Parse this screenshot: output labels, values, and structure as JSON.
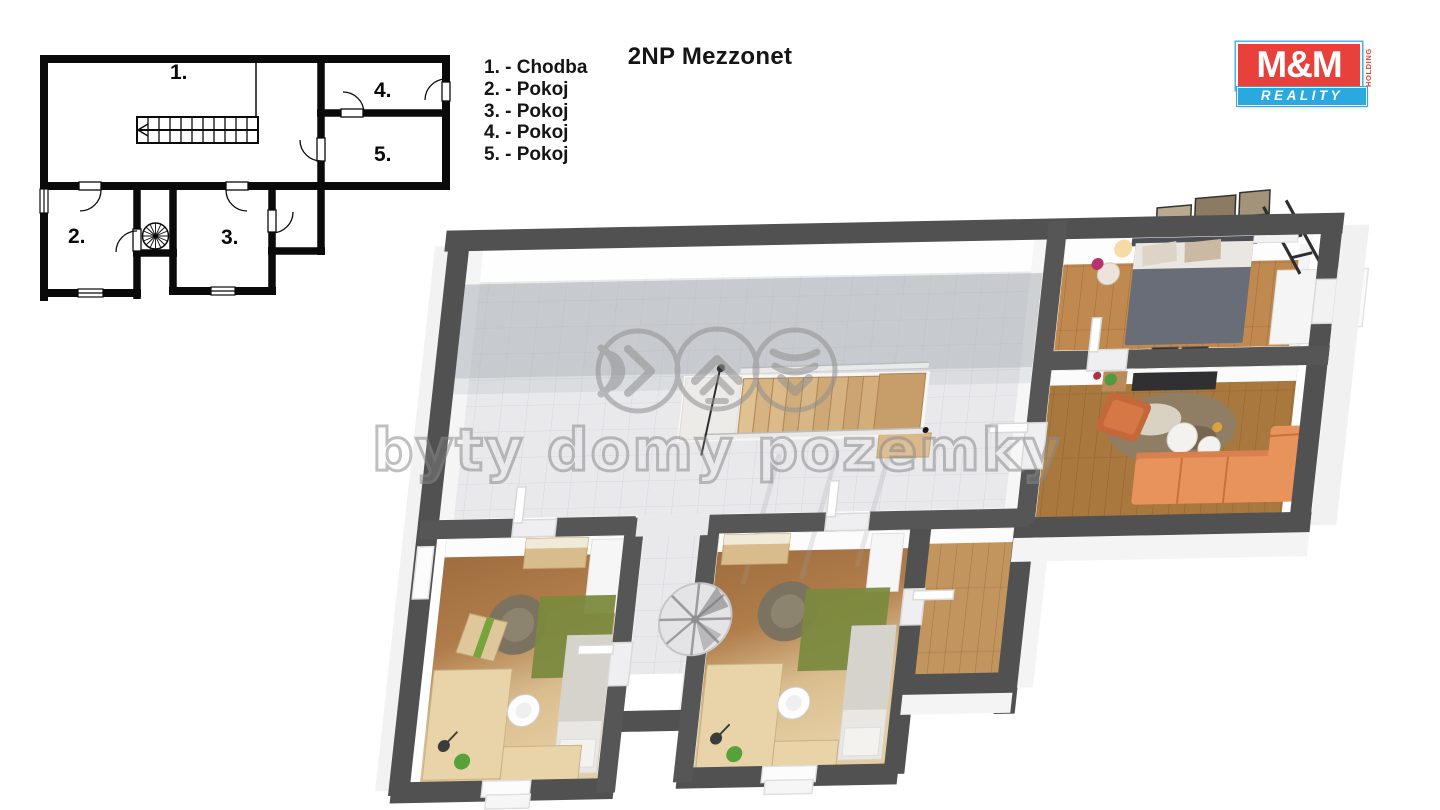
{
  "title": "2NP Mezzonet",
  "legend": {
    "items": [
      "1. - Chodba",
      "2. - Pokoj",
      "3. - Pokoj",
      "4. - Pokoj",
      "5. - Pokoj"
    ]
  },
  "plan2d": {
    "labels": [
      "1.",
      "2.",
      "3.",
      "4.",
      "5."
    ]
  },
  "watermark": {
    "text": "byty domy pozemky"
  },
  "logo": {
    "mm": "M&M",
    "holding": "HOLDING",
    "reality": "REALITY",
    "red": "#e8403a",
    "blue": "#2aa9e0"
  },
  "colors": {
    "wall": "#565656",
    "wall_outer": "#515151",
    "tile": "#e9e9ec",
    "wood_bedroom": "#bf8950",
    "wood_living": "#a9783f",
    "wood_small": "#c2955e",
    "rug_green": "#7b8a3e",
    "sofa_orange": "#e8935c",
    "plan_line": "#0a0a0a",
    "watermark_gray": "#8c8c8e"
  }
}
